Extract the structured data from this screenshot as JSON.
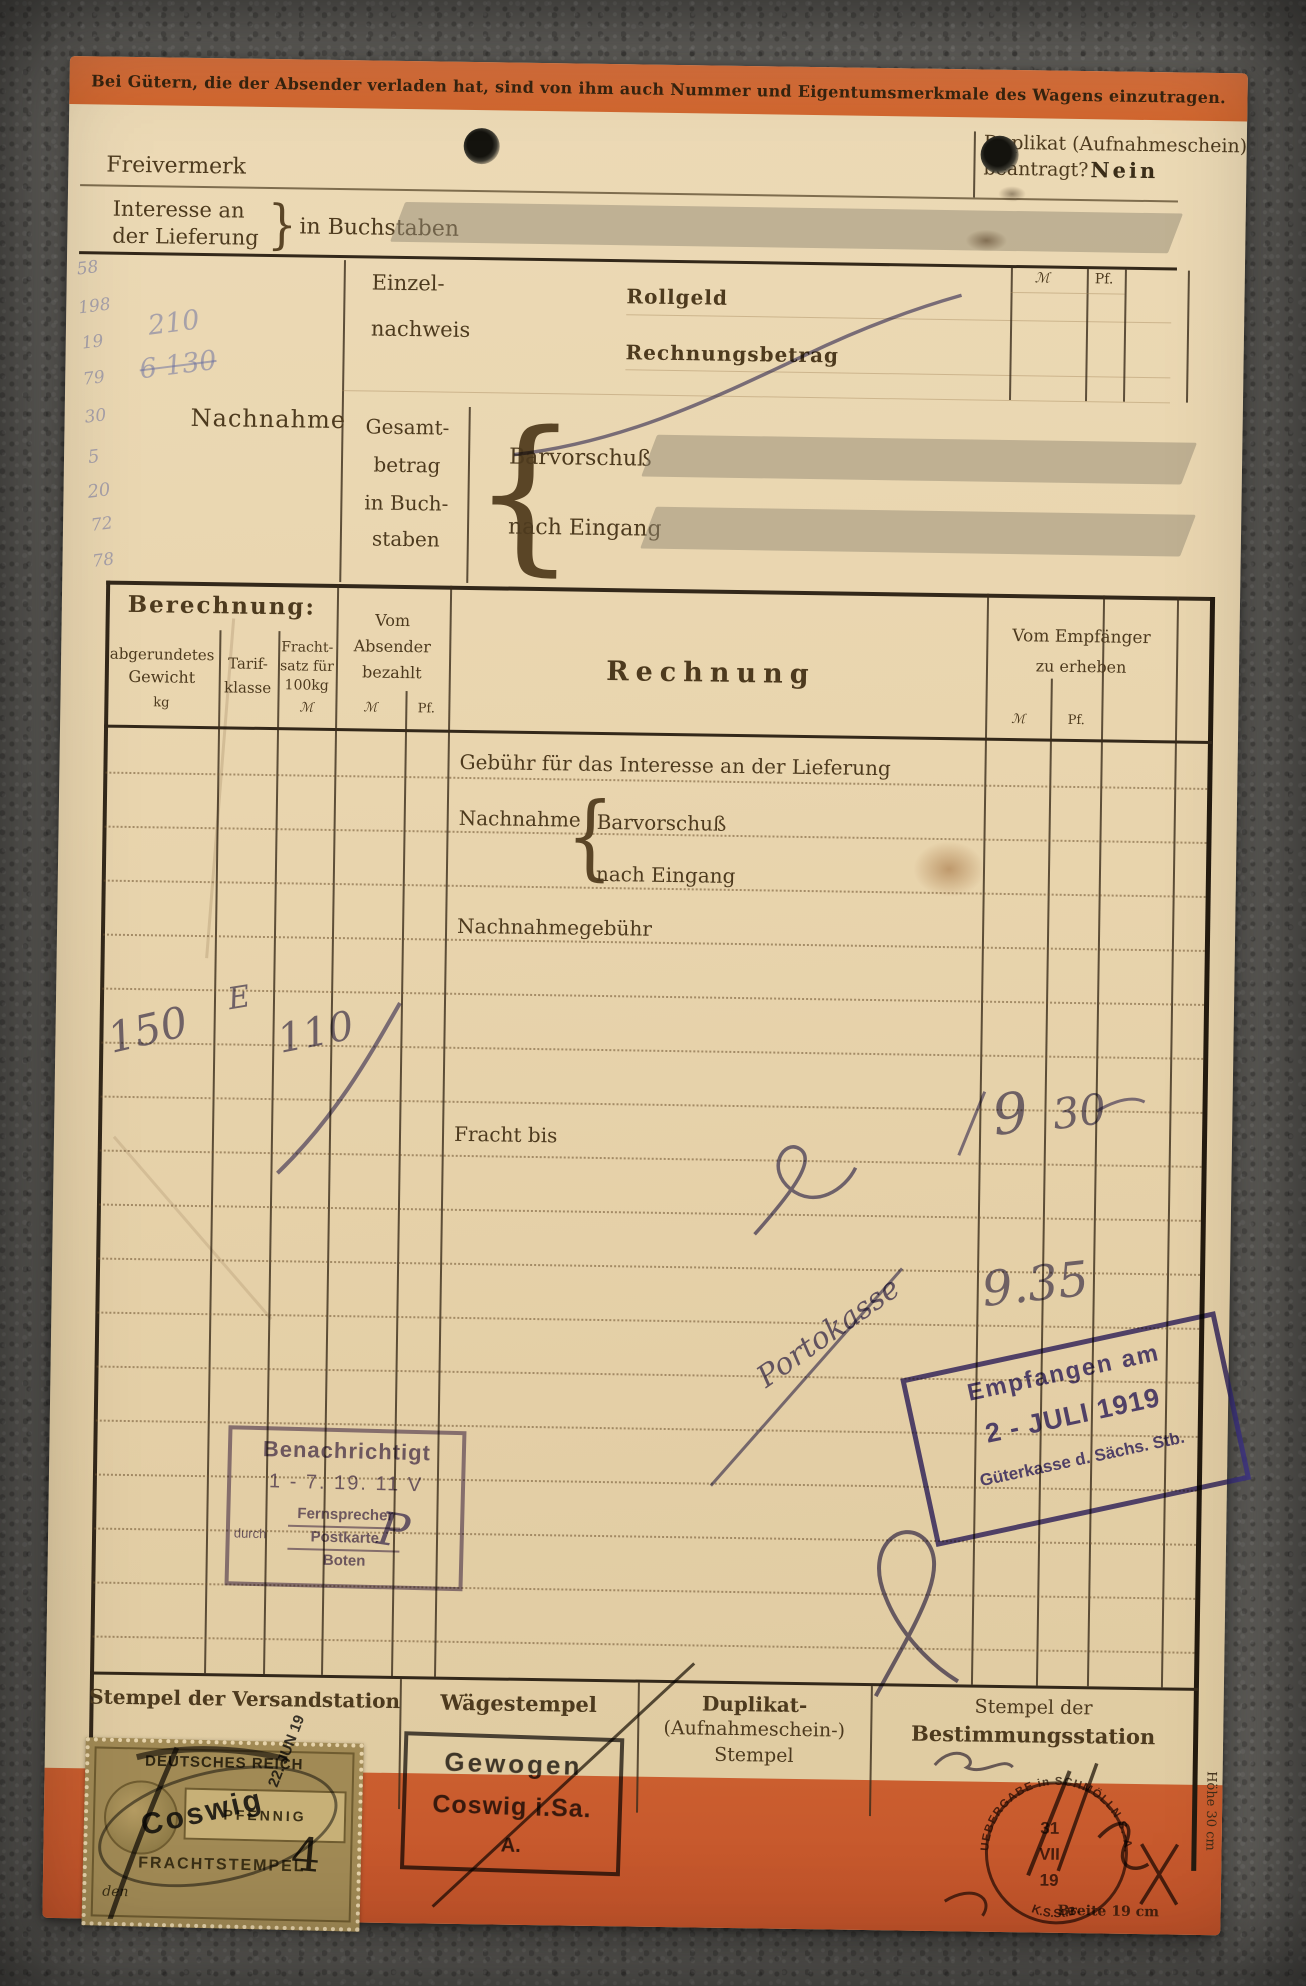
{
  "banner": {
    "notice": "Bei Gütern, die der Absender verladen hat, sind von ihm auch Nummer und Eigentumsmerkmale des Wagens einzutragen."
  },
  "glyphs": {
    "brace_open": "{",
    "brace_close": "}"
  },
  "header": {
    "freivermerk": "Freivermerk",
    "duplikat_line1": "Duplikat (Aufnahmeschein)",
    "duplikat_line2": "beantragt?",
    "duplikat_answer": "Nein",
    "interesse_line1": "Interesse an",
    "interesse_line2": "der Lieferung",
    "in_buchstaben": "in Buchstaben"
  },
  "einzelnachweis": {
    "label1": "Einzel-",
    "label2": "nachweis",
    "row1": "Rollgeld",
    "row2": "Rechnungsbetrag",
    "mark": "ℳ",
    "pfennig": "Pf."
  },
  "nachnahme": {
    "label": "Nachnahme",
    "gesamt1": "Gesamt-",
    "gesamt2": "betrag",
    "gesamt3": "in Buch-",
    "gesamt4": "staben",
    "barvorschuss": "Barvorschuß",
    "nach_eingang": "nach Eingang"
  },
  "table": {
    "berechnung": "Berechnung:",
    "gewicht1": "abgerundetes",
    "gewicht2": "Gewicht",
    "gewicht3": "kg",
    "tarif1": "Tarif-",
    "tarif2": "klasse",
    "fracht1": "Fracht-",
    "fracht2": "satz für",
    "fracht3": "100kg",
    "fracht4": "ℳ",
    "absender1": "Vom",
    "absender2": "Absender",
    "absender3": "bezahlt",
    "mark": "ℳ",
    "pfennig": "Pf.",
    "rechnung": "Rechnung",
    "empfaenger1": "Vom Empfänger",
    "empfaenger2": "zu erheben",
    "row_gebuehr": "Gebühr für das Interesse an der Lieferung",
    "row_nachnahme": "Nachnahme",
    "row_barvorschuss": "Barvorschuß",
    "row_nach_eingang": "nach Eingang",
    "row_nachnahmegebuehr": "Nachnahmegebühr",
    "row_fracht_bis": "Fracht bis"
  },
  "handwriting": {
    "gewicht": "150",
    "tarifklasse": "E",
    "frachtsatz": "110",
    "fracht_mark": "9",
    "fracht_pf": "30",
    "empfaenger_total": "9.35",
    "portokasse": "Portokasse",
    "benachrichtigt_mark": "P",
    "frachtstempel_mark": "4",
    "margin": [
      "58",
      "198",
      "19",
      "79",
      "210",
      "6 130",
      "30",
      "5",
      "20",
      "72",
      "78"
    ]
  },
  "stamps": {
    "benachrichtigt": {
      "title": "Benachrichtigt",
      "date": "1 - 7. 19. 11 V",
      "durch": "durch",
      "opt1": "Fernsprecher",
      "opt2": "Postkarte",
      "opt3": "Boten"
    },
    "empfangen": {
      "line1": "Empfangen am",
      "line2": "2 - JULI 1919",
      "line3": "Güterkasse d. Sächs. Stb."
    },
    "gewogen": {
      "line1": "Gewogen",
      "line2": "Coswig i.Sa.",
      "line3": "A."
    },
    "frachtmarke": {
      "country": "DEUTSCHES REICH",
      "value": "PFENNIG",
      "type": "FRACHTSTEMPEL",
      "den": "den",
      "overprint_ort": "Coswig",
      "overprint_date": "22. JUN 19"
    },
    "uebergabe": {
      "ring": "UEBERGABE in SCHMÖLLN S.-A.",
      "day": "31",
      "month": "VII",
      "year": "19",
      "bottom": "K.S.St.B."
    }
  },
  "footer": {
    "versand": "Stempel der Versandstation",
    "waege": "Wägestempel",
    "duplikat1": "Duplikat-",
    "duplikat2": "(Aufnahmeschein-)",
    "duplikat3": "Stempel",
    "bestimmung1": "Stempel der",
    "bestimmung2": "Bestimmungsstation",
    "breite": "Breite 19 cm",
    "hoehe": "Höhe 30 cm"
  }
}
